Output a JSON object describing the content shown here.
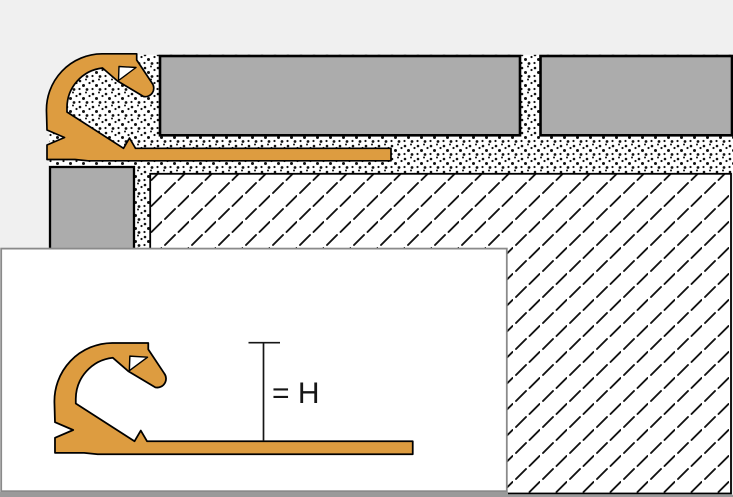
{
  "inset": {
    "dimension_label": "= H"
  },
  "colors": {
    "background": "#f0f0f0",
    "profile_orange": "#dd9c40",
    "tile_gray": "#acacac",
    "outline": "#000000",
    "speckle_dot": "#111111",
    "hatch_mark": "#111111",
    "inset_border": "#8a8a8a",
    "bottom_bar": "#9a9a9a"
  }
}
